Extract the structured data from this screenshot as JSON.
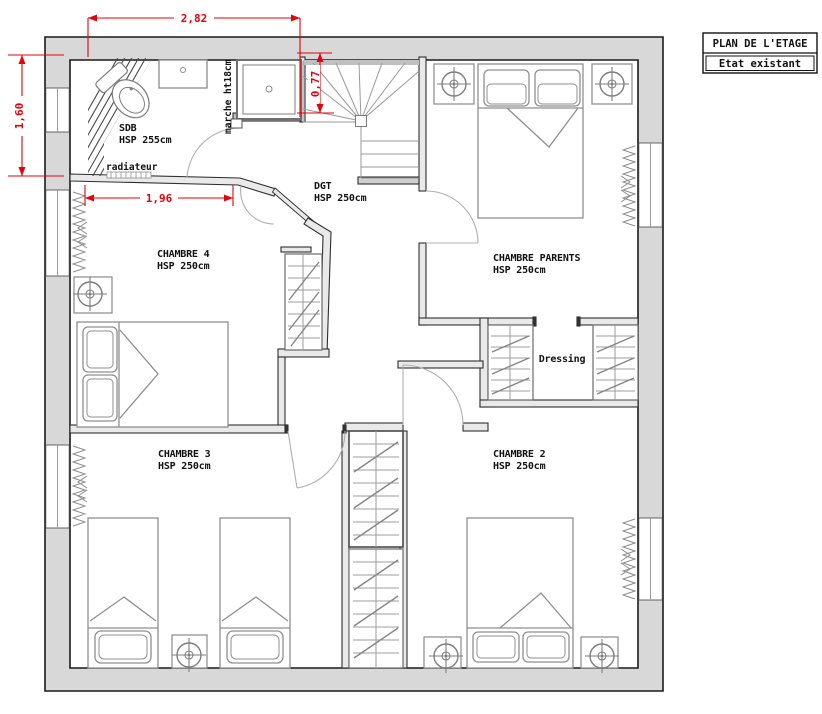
{
  "legend": {
    "title": "PLAN DE L'ETAGE",
    "status": "Etat existant"
  },
  "rooms": {
    "sdb": {
      "name": "SDB",
      "height": "HSP 255cm"
    },
    "dgt": {
      "name": "DGT",
      "height": "HSP 250cm"
    },
    "chambre4": {
      "name": "CHAMBRE 4",
      "height": "HSP 250cm"
    },
    "chambre_parents": {
      "name": "CHAMBRE PARENTS",
      "height": "HSP 250cm"
    },
    "dressing": {
      "name": "Dressing"
    },
    "chambre3": {
      "name": "CHAMBRE 3",
      "height": "HSP 250cm"
    },
    "chambre2": {
      "name": "CHAMBRE 2",
      "height": "HSP 250cm"
    }
  },
  "annotations": {
    "radiator": "radiateur",
    "step": "marche ht18cm"
  },
  "dimensions": {
    "top_width": "2,82",
    "left_height": "1,60",
    "chambre4_wall": "1,96",
    "stair_width": "0,77"
  },
  "colors": {
    "dimension_red": "#e8000a",
    "exterior_wall_gray": "#d8d8d8",
    "furniture_gray": "#8f8f8f"
  }
}
